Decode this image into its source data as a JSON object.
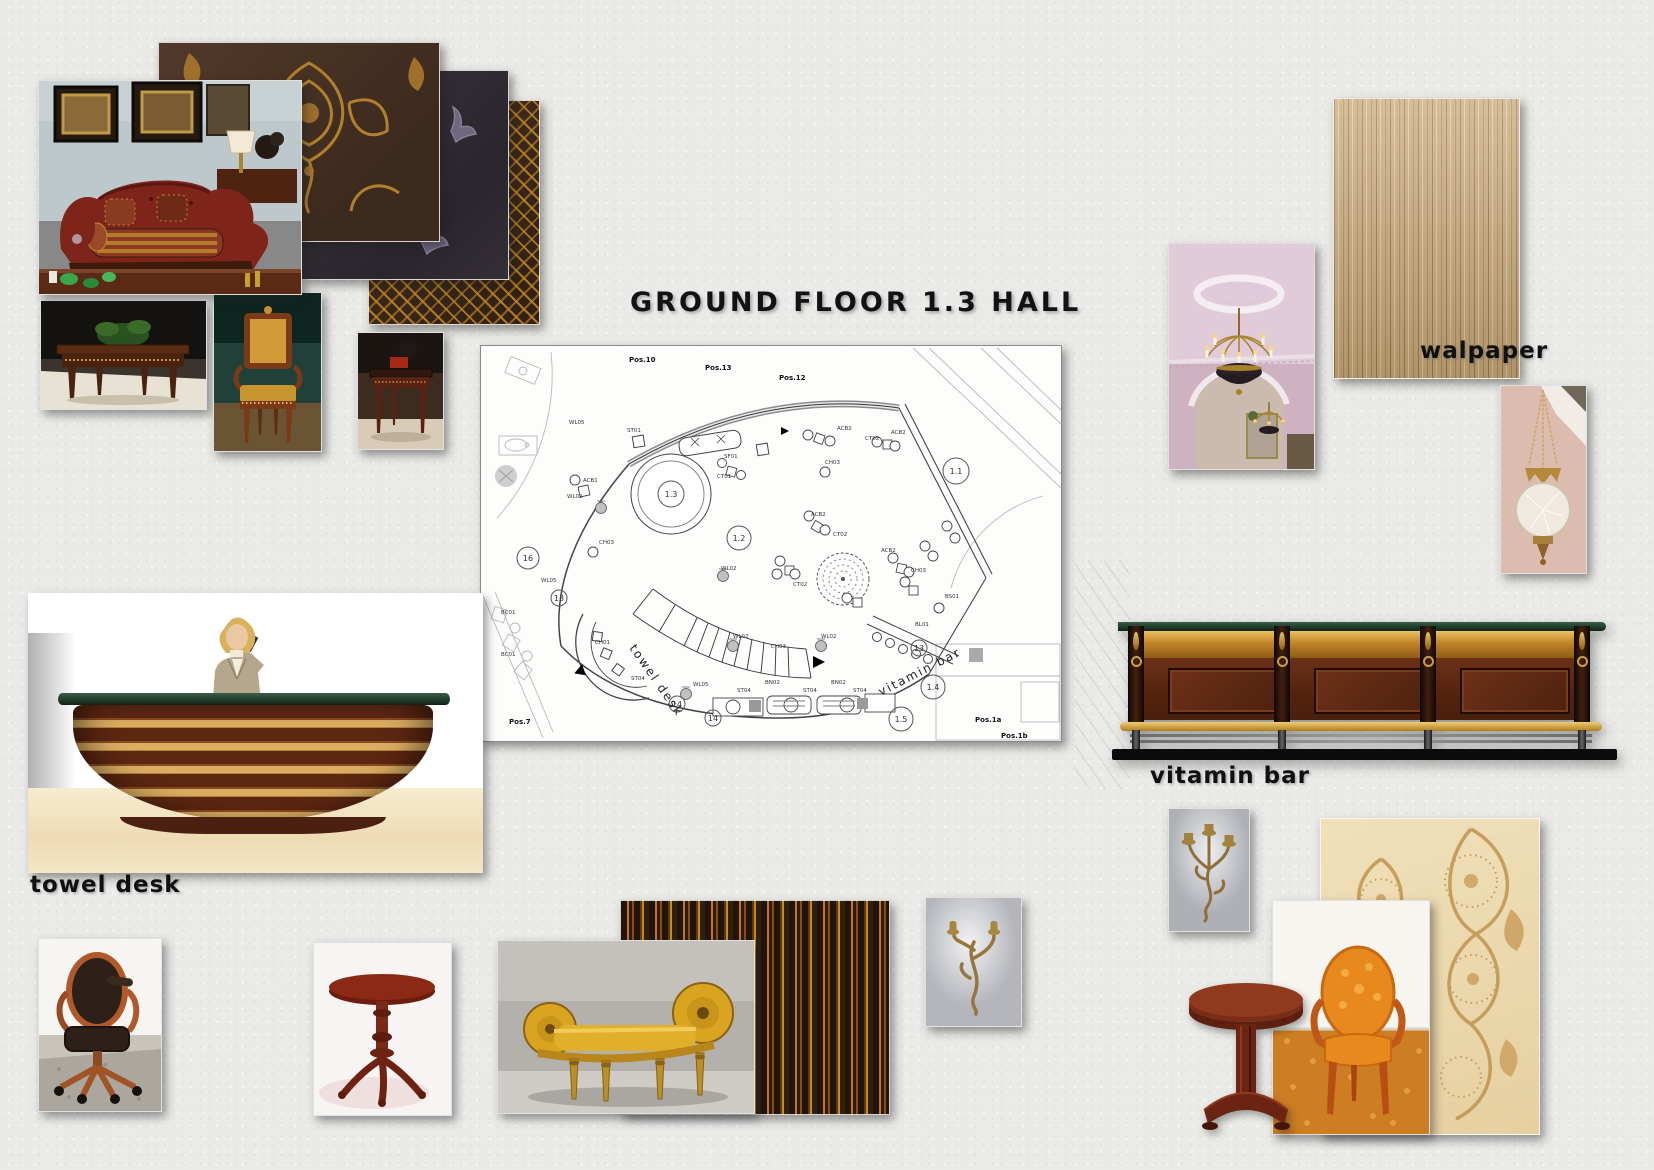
{
  "page": {
    "title": "GROUND FLOOR 1.3 HALL",
    "background": "#eaeae8"
  },
  "captions": {
    "towel_desk": "towel desk",
    "vitamin_bar": "vitamin bar",
    "wallpaper": "walpaper"
  },
  "palette": {
    "mahogany": "#5c2815",
    "gold": "#c89232",
    "dark_green_marble": "#16301f",
    "burgundy_sofa": "#7e241a",
    "cream_damask": "#eedcb2",
    "tan_wallpaper": "#c8a878",
    "orange_chair": "#e8891e"
  },
  "floor_plan": {
    "position_labels": [
      "Pos.10",
      "Pos.13",
      "Pos.12",
      "Pos.7",
      "Pos.1a",
      "Pos.1b"
    ],
    "area_numbers": [
      "1.1",
      "1.2",
      "1.3",
      "1.4",
      "1.5",
      "16",
      "13",
      "13",
      "14",
      "14"
    ],
    "annotations": [
      "towel desk",
      "vitamin bar"
    ],
    "furniture_codes": [
      "WL05",
      "ST01",
      "SF01",
      "CT01",
      "ACB1",
      "WL02",
      "CH03",
      "WL05",
      "ACB2",
      "CT02",
      "ACB2",
      "CH03",
      "ACB2",
      "CT02",
      "WL02",
      "ACB2",
      "CH03",
      "CT02",
      "BS01",
      "BL01",
      "CH01",
      "ST04",
      "WL05",
      "ST04",
      "BN02",
      "ST04",
      "BN02",
      "ST04",
      "CH03",
      "WL02",
      "WL02",
      "BC01",
      "BC01"
    ]
  }
}
